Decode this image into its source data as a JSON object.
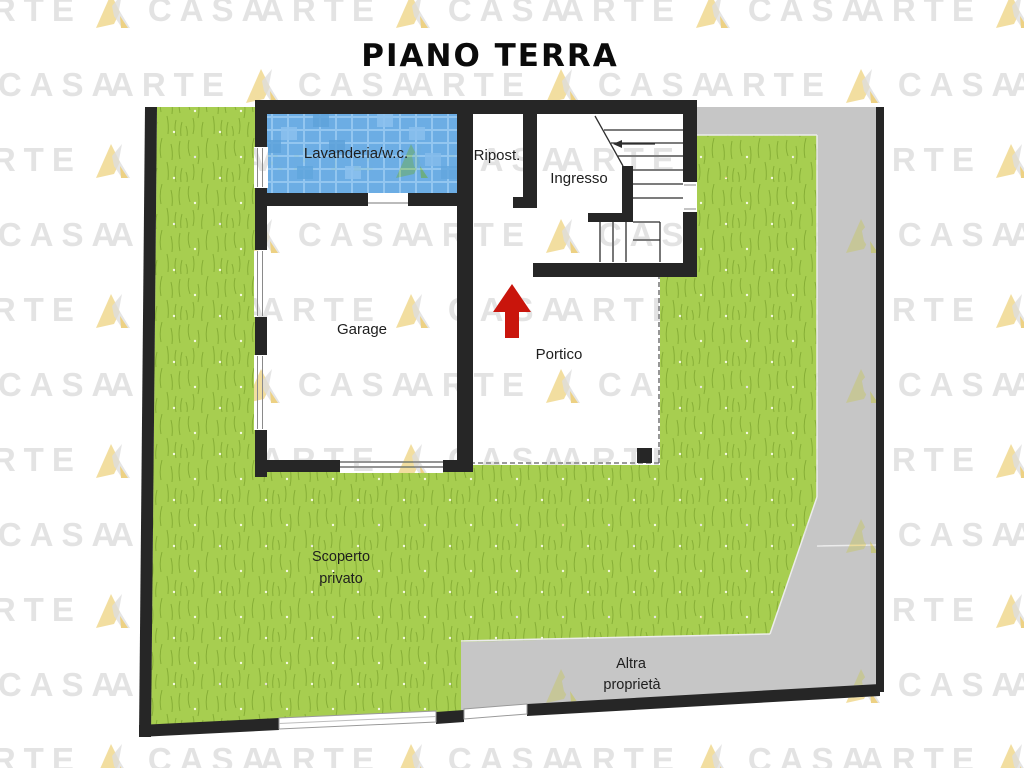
{
  "title": "PIANO TERRA",
  "floor_plan": {
    "rooms": {
      "lavanderia": {
        "label": "Lavanderia/w.c."
      },
      "ripostiglio": {
        "label": "Ripost."
      },
      "ingresso": {
        "label": "Ingresso"
      },
      "garage": {
        "label": "Garage"
      },
      "portico": {
        "label": "Portico"
      }
    },
    "outdoor_areas": {
      "scoperto_privato": {
        "label_line1": "Scoperto",
        "label_line2": "privato"
      },
      "altra_proprieta": {
        "label_line1": "Altra",
        "label_line2": "proprietà"
      }
    }
  },
  "watermark": {
    "word_left": "ARTE",
    "word_right": "CASA"
  },
  "colors": {
    "grass": "#a7ce50",
    "grass_stroke": "#7ba32d",
    "pavement": "#c6c6c6",
    "wall": "#262626",
    "tile_blue": "#6cade4",
    "arrow_red": "#c9150c",
    "watermark_text": "#e3e3e3",
    "watermark_gold": "#f0d88f",
    "label_text": "#1e1e1e"
  }
}
